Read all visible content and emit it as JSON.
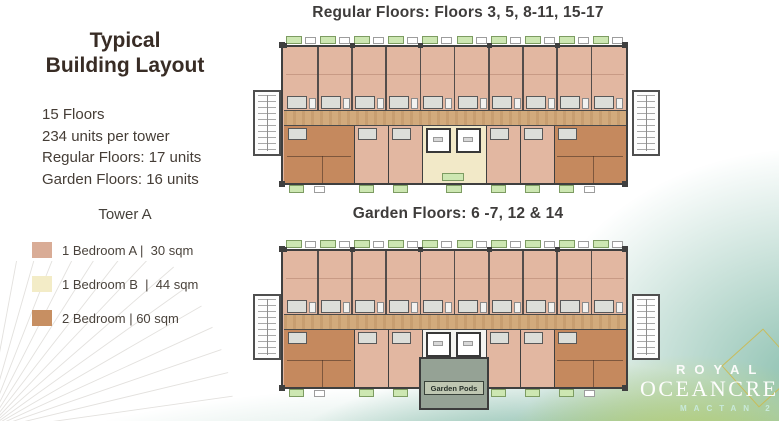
{
  "slide": {
    "left_panel": {
      "title_line1": "Typical",
      "title_line2": "Building Layout",
      "stats": [
        "15 Floors",
        "234 units per tower",
        "Regular Floors: 17 units",
        "Garden Floors: 16 units"
      ],
      "tower_label": "Tower A",
      "legend": [
        {
          "label": "1 Bedroom A |  30 sqm",
          "color": "#d9ac96"
        },
        {
          "label": "1 Bedroom B  |  44 sqm",
          "color": "#f3ecc7"
        },
        {
          "label": "2 Bedroom | 60 sqm",
          "color": "#c78f62"
        }
      ]
    },
    "plans": [
      {
        "id": "regular",
        "title": "Regular Floors: Floors 3, 5, 8-11, 15-17",
        "center_label": ""
      },
      {
        "id": "garden",
        "title": "Garden Floors: 6 -7, 12 & 14",
        "center_label": "Garden Pods"
      }
    ],
    "plan_colors": {
      "unit_1a": "#e2b7a1",
      "unit_1b": "#f2e9c8",
      "unit_2br": "#c5895e",
      "corridor": "#d2aa7c",
      "wall": "#3f3f3f",
      "balcony_chip": "#cde7b2",
      "garden_pods_fill": "#95a295",
      "pods_label_fill": "#bfc7b2",
      "stair_fill": "#fdfdfd",
      "fixture_fill": "#dcded9"
    },
    "logo": {
      "line1": "ROYAL",
      "line2": "OCEANCREST",
      "line3": "MACTAN 2",
      "accent": "#cdb94b"
    }
  }
}
